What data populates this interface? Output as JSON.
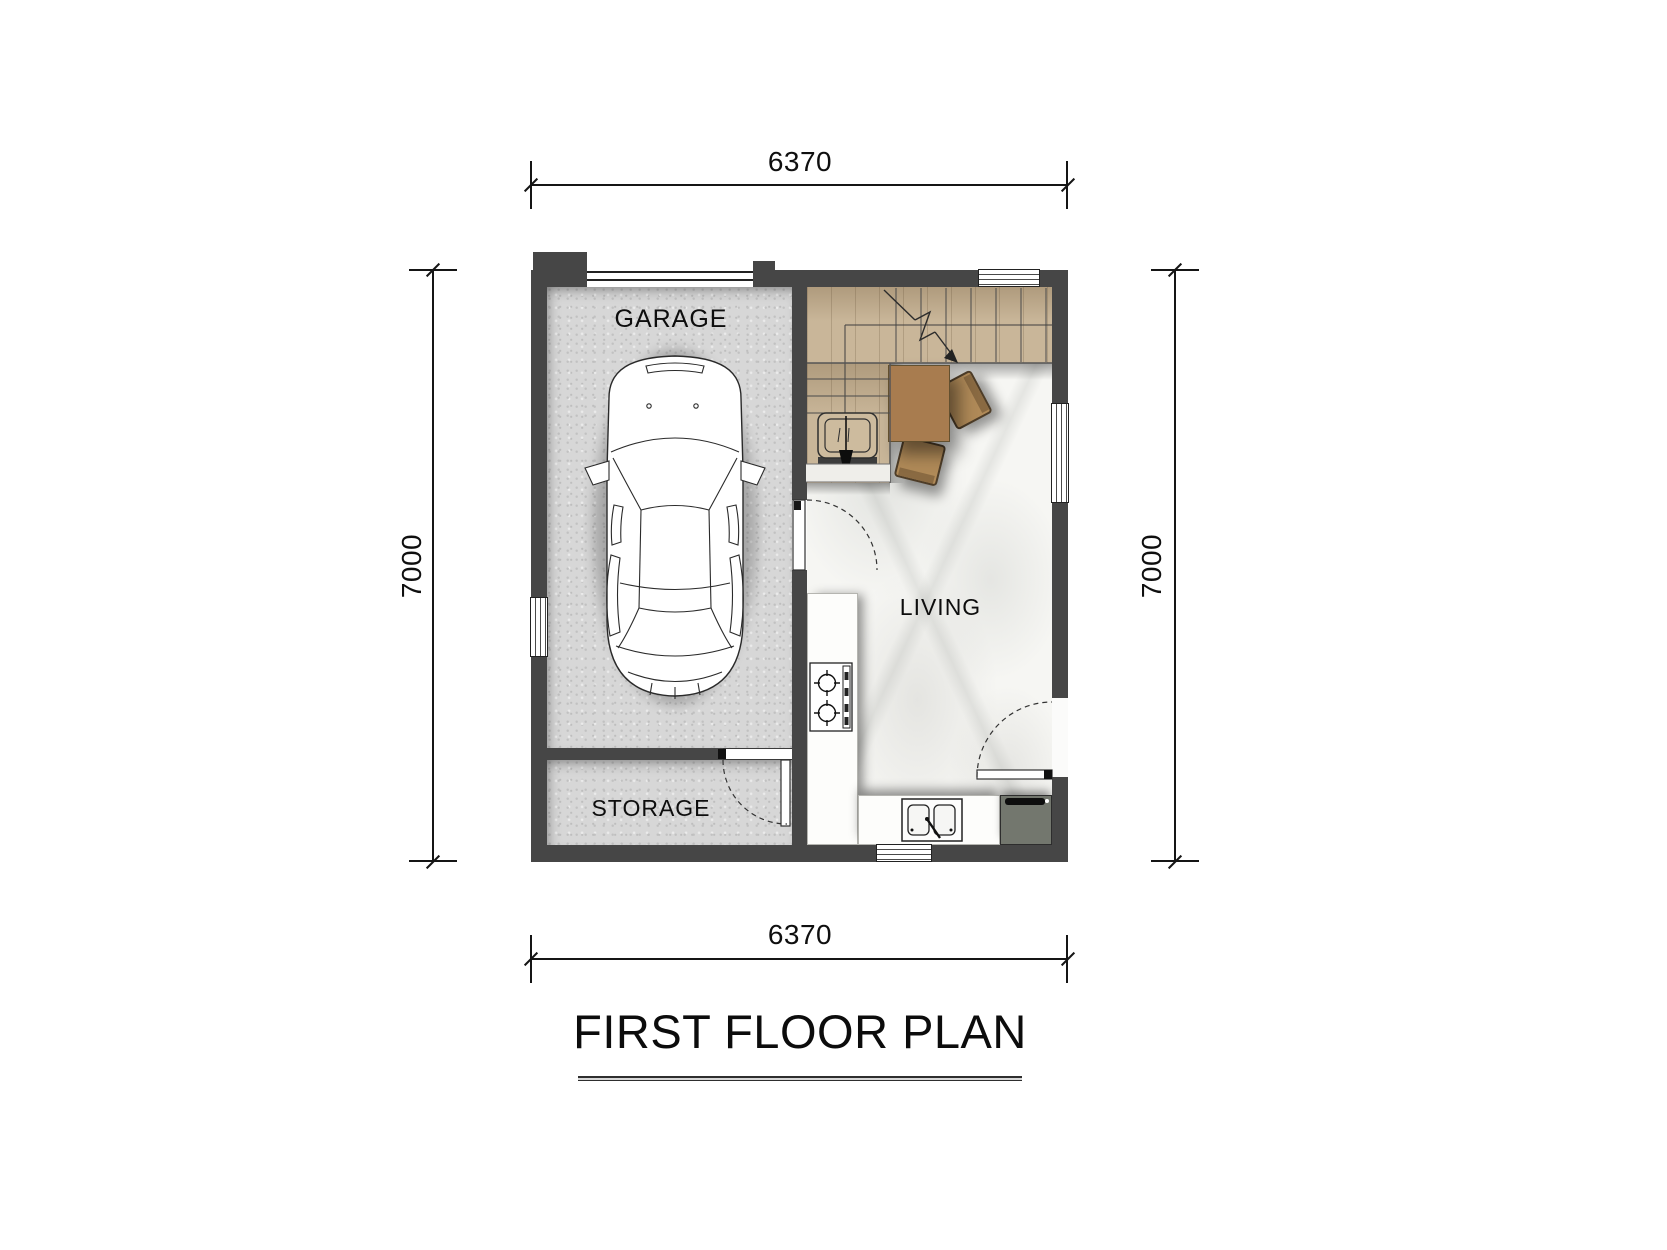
{
  "title": "FIRST FLOOR PLAN",
  "dimensions": {
    "top": "6370",
    "bottom": "6370",
    "left": "7000",
    "right": "7000"
  },
  "rooms": {
    "garage": {
      "label": "GARAGE"
    },
    "storage": {
      "label": "STORAGE"
    },
    "living": {
      "label": "LIVING"
    }
  },
  "fixtures": {
    "car": "car-top-view",
    "stairs": "staircase-with-break-arrow",
    "table": "dining-table",
    "chairs": "dining-chairs",
    "stove": "two-burner-stove",
    "sink": "double-bowl-sink",
    "appliance": "refrigerator",
    "doors": [
      "garage-to-living-door",
      "storage-door",
      "living-entry-door"
    ],
    "windows": [
      "left-wall-window",
      "top-wall-window",
      "right-wall-window",
      "bottom-wall-window"
    ],
    "garage_door": "garage-door-line"
  },
  "colors": {
    "wall": "#464646",
    "garage_floor": "#d7d7d7",
    "wood_floor": "#c9b699",
    "marble_floor": "#f6f6f3",
    "table_wood": "#a87c4f",
    "appliance": "#73776e",
    "line": "#151515"
  }
}
